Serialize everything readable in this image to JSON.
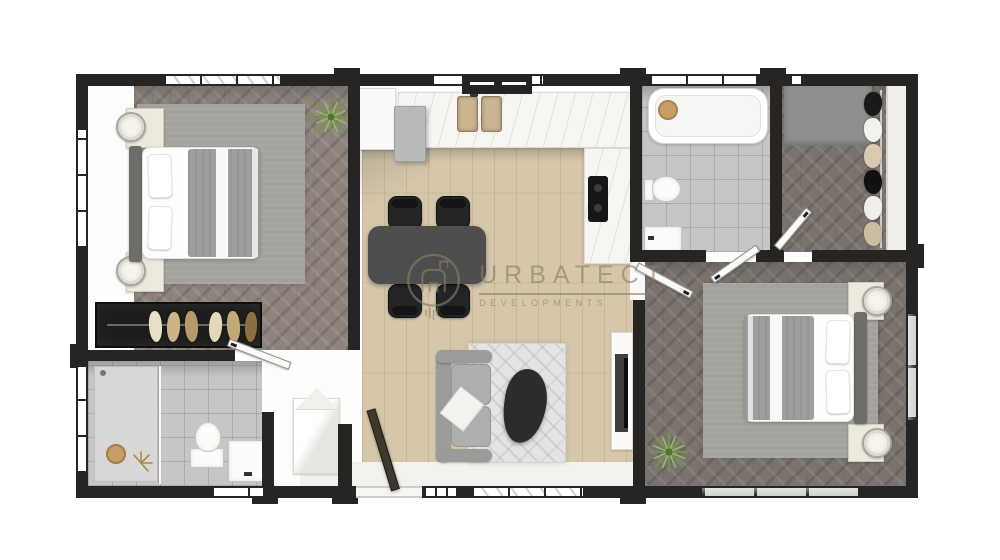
{
  "watermark": {
    "brand": "URBATECT",
    "tagline": "DEVELOPMENTS",
    "logo": "building-crane-in-circle-icon",
    "color": "#8a8066"
  },
  "palette": {
    "wall": "#262524",
    "wood": "#d6c7ab",
    "herrA": "#8e837c",
    "herrB": "#7b736e",
    "tile": "#c7c6c4",
    "rugGrey": "#a3a29c",
    "rugLiving": "#e4e4e2",
    "sofa": "#a7a8a6",
    "tableDark": "#4e4e4e",
    "chairBlack": "#242426",
    "counter": "#f6f5f2",
    "sinkTan": "#cbb691",
    "wardrobeDark": "#1d1d1c",
    "blanket": "#9f9f9d",
    "coffee": "#2c2c2e",
    "plant": "#74934f",
    "glass": "#cdd1cc",
    "wmColor": "#8a8066"
  },
  "plan": {
    "type": "residential-floor-plan-top-view",
    "rooms": [
      {
        "name": "bedroom-1",
        "position": "top-left",
        "floor": "dark-herringbone",
        "furniture": [
          "double-bed",
          "area-rug",
          "nightstand-with-lamp",
          "nightstand-with-lamp",
          "potted-plant"
        ]
      },
      {
        "name": "wardrobe-closet",
        "position": "mid-left",
        "floor": "none",
        "furniture": [
          "hanging-clothes-rail"
        ]
      },
      {
        "name": "bathroom-1",
        "position": "bottom-left",
        "floor": "grey-tile",
        "furniture": [
          "walk-in-shower",
          "toilet",
          "vanity-sink",
          "wood-stool"
        ]
      },
      {
        "name": "kitchen-dining",
        "position": "top-center",
        "floor": "light-wood",
        "furniture": [
          "l-shaped-counter",
          "double-sink",
          "cooktop",
          "fridge",
          "dining-table",
          "chair",
          "chair",
          "chair",
          "chair"
        ]
      },
      {
        "name": "living-entry",
        "position": "bottom-center",
        "floor": "light-wood",
        "furniture": [
          "sofa",
          "area-rug",
          "coffee-table",
          "tv-unit",
          "shoe-cabinet",
          "entry-door"
        ]
      },
      {
        "name": "bathroom-2",
        "position": "top-middle-right",
        "floor": "grey-tile",
        "furniture": [
          "bathtub",
          "toilet",
          "sink",
          "wood-stool"
        ]
      },
      {
        "name": "walk-in-closet",
        "position": "top-right",
        "floor": "dark-herringbone",
        "furniture": [
          "hanging-clothes-rail",
          "grey-mat"
        ]
      },
      {
        "name": "bedroom-2",
        "position": "bottom-right",
        "floor": "dark-herringbone",
        "furniture": [
          "double-bed",
          "area-rug",
          "nightstand-with-lamp",
          "nightstand-with-lamp",
          "potted-plant"
        ]
      }
    ]
  }
}
